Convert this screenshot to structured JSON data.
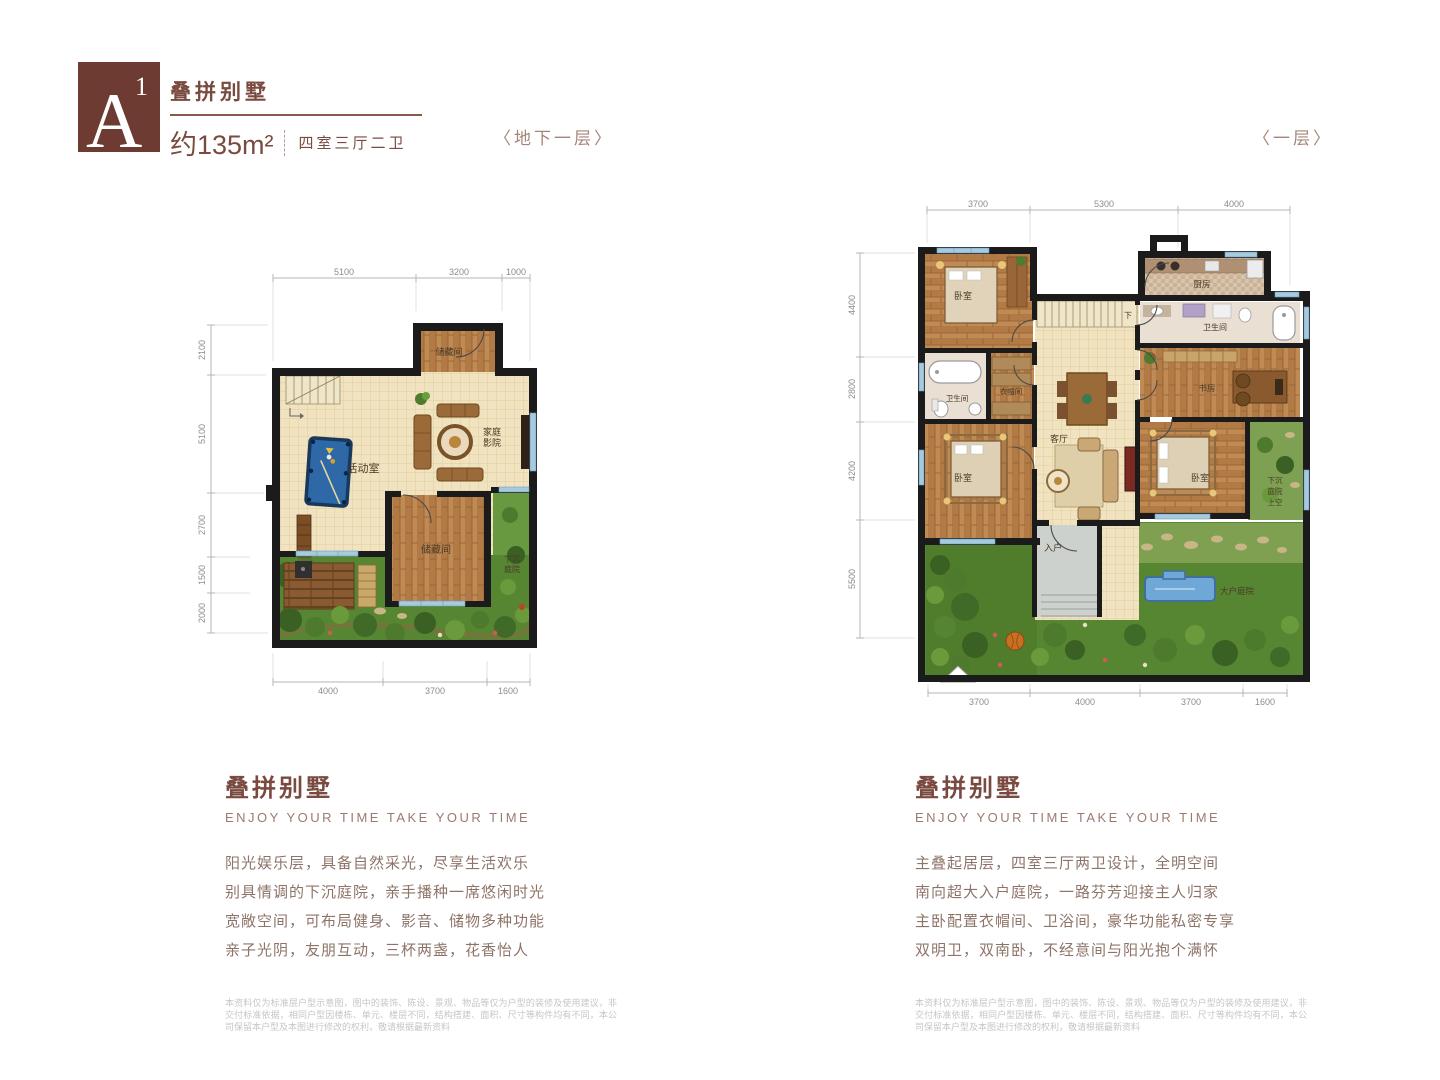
{
  "header": {
    "badge_letter": "A",
    "badge_sup": "1",
    "title": "叠拼别墅",
    "area": "约135m²",
    "layout": "四室三厅二卫"
  },
  "plans": {
    "basement": {
      "caption": "〈地下一层〉",
      "dims_top": [
        "5100",
        "3200",
        "1000"
      ],
      "dims_left": [
        "2100",
        "5100",
        "2700",
        "1500",
        "2000"
      ],
      "dims_bottom": [
        "4000",
        "3700",
        "1600"
      ],
      "rooms": {
        "storage_top": "储藏间",
        "activity": "活动室",
        "theater_1": "家庭",
        "theater_2": "影院",
        "storage_bottom": "储藏间",
        "sunken_1": "下沉",
        "sunken_2": "庭院"
      }
    },
    "first_floor": {
      "caption": "〈一层〉",
      "dims_top": [
        "3700",
        "5300",
        "4000"
      ],
      "dims_left": [
        "4400",
        "2800",
        "4200",
        "5500"
      ],
      "dims_bottom": [
        "3700",
        "4000",
        "3700",
        "1600"
      ],
      "rooms": {
        "bedroom_nw": "卧室",
        "bath_w": "卫生间",
        "closet": "衣帽间",
        "bedroom_sw": "卧室",
        "kitchen": "厨房",
        "bath_ne": "卫生间",
        "study": "书房",
        "living": "客厅",
        "bedroom_se": "卧室",
        "entry": "入户",
        "stairs_down": "下",
        "sunken_1": "下沉",
        "sunken_2": "庭院",
        "sunken_3": "上空",
        "garden": "大户庭院"
      }
    }
  },
  "sections": {
    "left": {
      "title": "叠拼别墅",
      "subtitle": "ENJOY YOUR TIME  TAKE YOUR TIME",
      "lines": [
        "阳光娱乐层，具备自然采光，尽享生活欢乐",
        "别具情调的下沉庭院，亲手播种一席悠闲时光",
        "宽敞空间，可布局健身、影音、储物多种功能",
        "亲子光阴，友朋互动，三杯两盏，花香怡人"
      ],
      "disclaimer": "本资料仅为标准层户型示意图，图中的装饰、陈设、景观、物品等仅为户型的装修及使用建议，非交付标准依据，相同户型因楼栋、单元、楼层不同，结构搭建、面积、尺寸等构件均有不同，本公司保留本户型及本图进行修改的权利，敬请根据最新资料"
    },
    "right": {
      "title": "叠拼别墅",
      "subtitle": "ENJOY YOUR TIME  TAKE YOUR TIME",
      "lines": [
        "主叠起居层，四室三厅两卫设计，全明空间",
        "南向超大入户庭院，一路芬芳迎接主人归家",
        "主卧配置衣帽间、卫浴间，豪华功能私密专享",
        "双明卫，双南卧，不经意间与阳光抱个满怀"
      ],
      "disclaimer": "本资料仅为标准层户型示意图，图中的装饰、陈设、景观、物品等仅为户型的装修及使用建议，非交付标准依据，相同户型因楼栋、单元、楼层不同，结构搭建、面积、尺寸等构件均有不同，本公司保留本户型及本图进行修改的权利，敬请根据最新资料"
    }
  }
}
